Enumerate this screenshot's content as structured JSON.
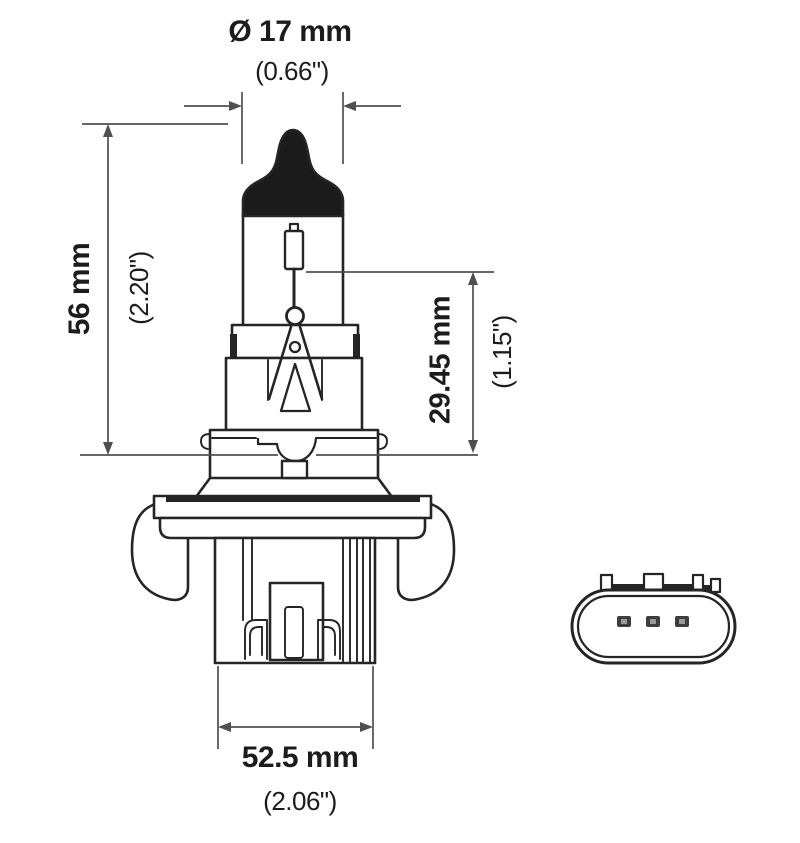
{
  "figure": {
    "type": "technical-drawing",
    "subject": "halogen headlight bulb side view with dimensions and connector front view",
    "background_color": "#ffffff",
    "ink_color": "#252525",
    "dimension_line_color": "#4f4f4f",
    "pin_color": "#3d3d3d"
  },
  "dimensions": {
    "diameter": {
      "metric": "Ø 17 mm",
      "imperial": "(0.66\")"
    },
    "overall_length": {
      "metric": "56 mm",
      "imperial": "(2.20\")"
    },
    "focal_length": {
      "metric": "29.45 mm",
      "imperial": "(1.15\")"
    },
    "base_width": {
      "metric": "52.5 mm",
      "imperial": "(2.06\")"
    }
  }
}
